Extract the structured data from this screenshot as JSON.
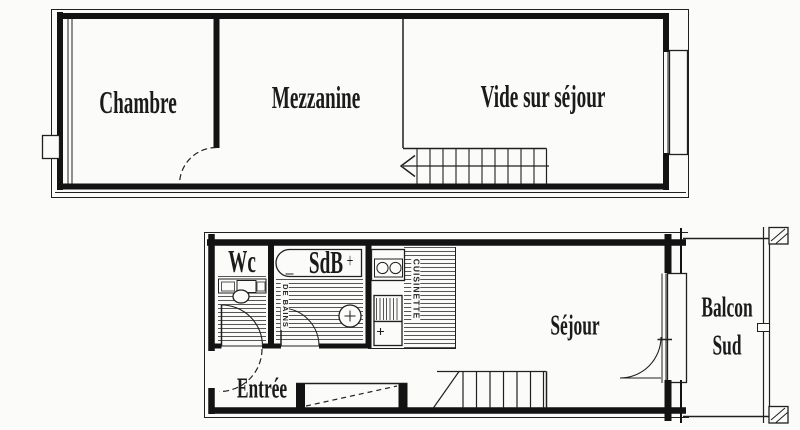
{
  "colors": {
    "background": "#fbfbf9",
    "line": "#202020",
    "wall": "#131313",
    "hatch": "#3c3c3c"
  },
  "upper_level": {
    "chambre": "Chambre",
    "mezzanine": "Mezzanine",
    "vide_sur_sejour": "Vide sur séjour"
  },
  "lower_level": {
    "wc": "Wc",
    "sdb": "SdB",
    "sdb_plus": "+",
    "salle_de_bains": "DE BAINS",
    "cuisinette": "CUISINETTE",
    "entree": "Entrée",
    "sejour": "Séjour",
    "balcon": "Balcon",
    "sud": "Sud"
  }
}
